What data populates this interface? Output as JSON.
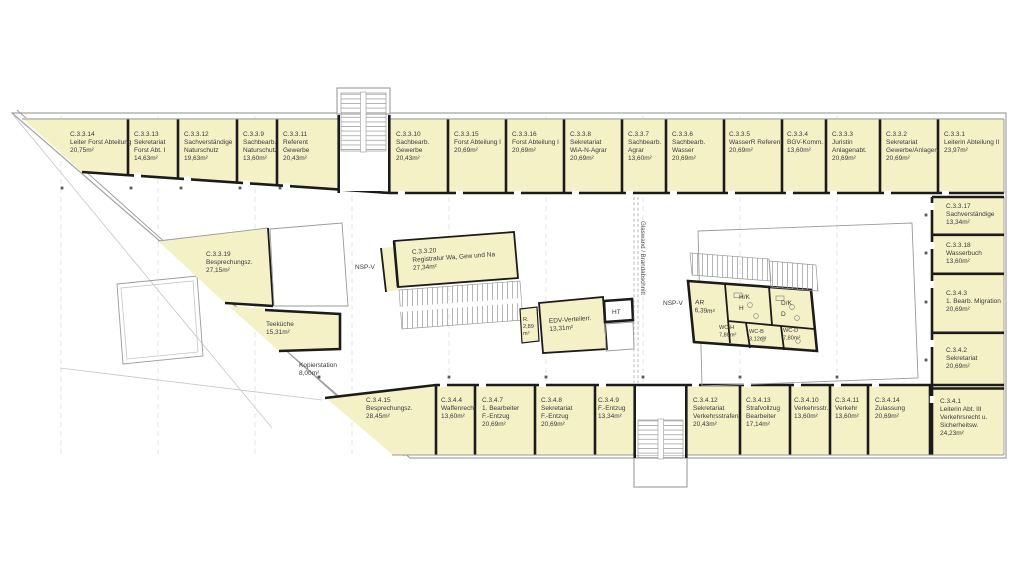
{
  "plan": {
    "colors": {
      "room_fill": "#f5f1c7",
      "wall_color": "#1b1b1b",
      "text_color": "#3a3a3a"
    },
    "glass_wall_note": "Glaswand / Brandabschnitt",
    "rooms": {
      "top": [
        {
          "lines": [
            "C.3.3.14",
            "Leiter Forst Abteilung",
            "20,75m²"
          ]
        },
        {
          "lines": [
            "C.3.3.13",
            "Sekretariat",
            "Forst Abt. I",
            "14,63m²"
          ]
        },
        {
          "lines": [
            "C.3.3.12",
            "Sachverständige",
            "Naturschutz",
            "19,63m²"
          ]
        },
        {
          "lines": [
            "C.3.3.9",
            "Sachbearb.",
            "Naturschutz",
            "13,60m²"
          ]
        },
        {
          "lines": [
            "C.3.3.11",
            "Referent",
            "Gewerbe",
            "20,43m²"
          ]
        },
        {
          "lines": [
            "C.3.3.10",
            "Sachbearb.",
            "Gewerbe",
            "20,43m²"
          ]
        },
        {
          "lines": [
            "C.3.3.15",
            "Forst Abteilung I",
            "20,69m²"
          ]
        },
        {
          "lines": [
            "C.3.3.16",
            "Forst Abteilung I",
            "20,69m²"
          ]
        },
        {
          "lines": [
            "C.3.3.8",
            "Sekretariat",
            "WiA-N-Agrar",
            "20,69m²"
          ]
        },
        {
          "lines": [
            "C.3.3.7",
            "Sachbearb.",
            "Agrar",
            "13,60m²"
          ]
        },
        {
          "lines": [
            "C.3.3.6",
            "Sachbearb.",
            "Wasser",
            "20,69m²"
          ]
        },
        {
          "lines": [
            "C.3.3.5",
            "WasserR Referent",
            "20,69m²"
          ]
        },
        {
          "lines": [
            "C.3.3.4",
            "BGV-Komm.",
            "13,60m²"
          ]
        },
        {
          "lines": [
            "C.3.3.3",
            "Juristin",
            "Anlagenabt.",
            "20,69m²"
          ]
        },
        {
          "lines": [
            "C.3.3.2",
            "Sekretariat",
            "Gewerbe/Anlagen",
            "20,69m²"
          ]
        },
        {
          "lines": [
            "C.3.3.1",
            "Leiterin Abteilung II",
            "23,97m²"
          ]
        }
      ],
      "right_column": [
        {
          "lines": [
            "C.3.3.17",
            "Sachverständige",
            "13,34m²"
          ]
        },
        {
          "lines": [
            "C.3.3.18",
            "Wasserbuch",
            "13,60m²"
          ]
        },
        {
          "lines": [
            "C.3.4.3",
            "1. Bearb. Migration",
            "20,69m²"
          ]
        },
        {
          "lines": [
            "C.3.4.2",
            "Sekretariat",
            "20,69m²"
          ]
        },
        {
          "lines": [
            "C.3.4.1",
            "Leiterin Abt. III",
            "Verkehrsrecht u.",
            "Sicherheitsw.",
            "24,23m²"
          ]
        }
      ],
      "bottom": [
        {
          "lines": [
            "C.3.4.15",
            "Besprechungsz.",
            "28,45m²"
          ]
        },
        {
          "lines": [
            "C.3.4.4",
            "Waffenrecht",
            "13,60m²"
          ]
        },
        {
          "lines": [
            "C.3.4.7",
            "1. Bearbeiter",
            "F.-Entzug",
            "20,69m²"
          ]
        },
        {
          "lines": [
            "C.3.4.8",
            "Sekretariat",
            "F.-Entzug",
            "20,69m²"
          ]
        },
        {
          "lines": [
            "C.3.4.9",
            "F.-Entzug",
            "13,34m²"
          ]
        },
        {
          "lines": [
            "C.3.4.12",
            "Sekretariat",
            "Verkehrsstrafen",
            "20,43m²"
          ]
        },
        {
          "lines": [
            "C.3.4.13",
            "Strafvollzug",
            "Bearbeiter",
            "17,14m²"
          ]
        },
        {
          "lines": [
            "C.3.4.10",
            "Verkehrsstr.",
            "13,60m²"
          ]
        },
        {
          "lines": [
            "C.3.4.11",
            "Verkehr",
            "13,60m²"
          ]
        },
        {
          "lines": [
            "C.3.4.14",
            "Zulassung",
            "20,69m²"
          ]
        }
      ],
      "center": {
        "besprechung": {
          "lines": [
            "C.3.3.19",
            "Besprechungsz.",
            "27,15m²"
          ]
        },
        "teekueche": {
          "lines": [
            "Teeküche",
            "15,31m²"
          ]
        },
        "kopierstation": {
          "lines": [
            "Kopierstation",
            "8,00m²"
          ]
        },
        "nsp_v_left": {
          "lines": [
            "NSP-V"
          ]
        },
        "registratur": {
          "lines": [
            "C.3.3.20",
            "Registratur Wa, Gew und Na",
            "27,34m²"
          ]
        },
        "r_raum": {
          "lines": [
            "R.",
            "2,89",
            "m²"
          ]
        },
        "edv": {
          "lines": [
            "EDV-Verteilerr.",
            "13,31m²"
          ]
        },
        "ht": {
          "lines": [
            "HT"
          ]
        },
        "nsp_v_right": {
          "lines": [
            "NSP-V"
          ]
        },
        "ar": {
          "lines": [
            "AR",
            "6,39m²"
          ]
        },
        "hk": {
          "lines": [
            "H/K",
            "H"
          ]
        },
        "dk": {
          "lines": [
            "D/K",
            "D"
          ]
        },
        "wc_h": {
          "lines": [
            "WC-H",
            "7,80m²"
          ]
        },
        "wc_b": {
          "lines": [
            "WC-B",
            "3,12m²"
          ]
        },
        "wc_d": {
          "lines": [
            "WC-D",
            "7,80m²"
          ]
        }
      }
    }
  }
}
